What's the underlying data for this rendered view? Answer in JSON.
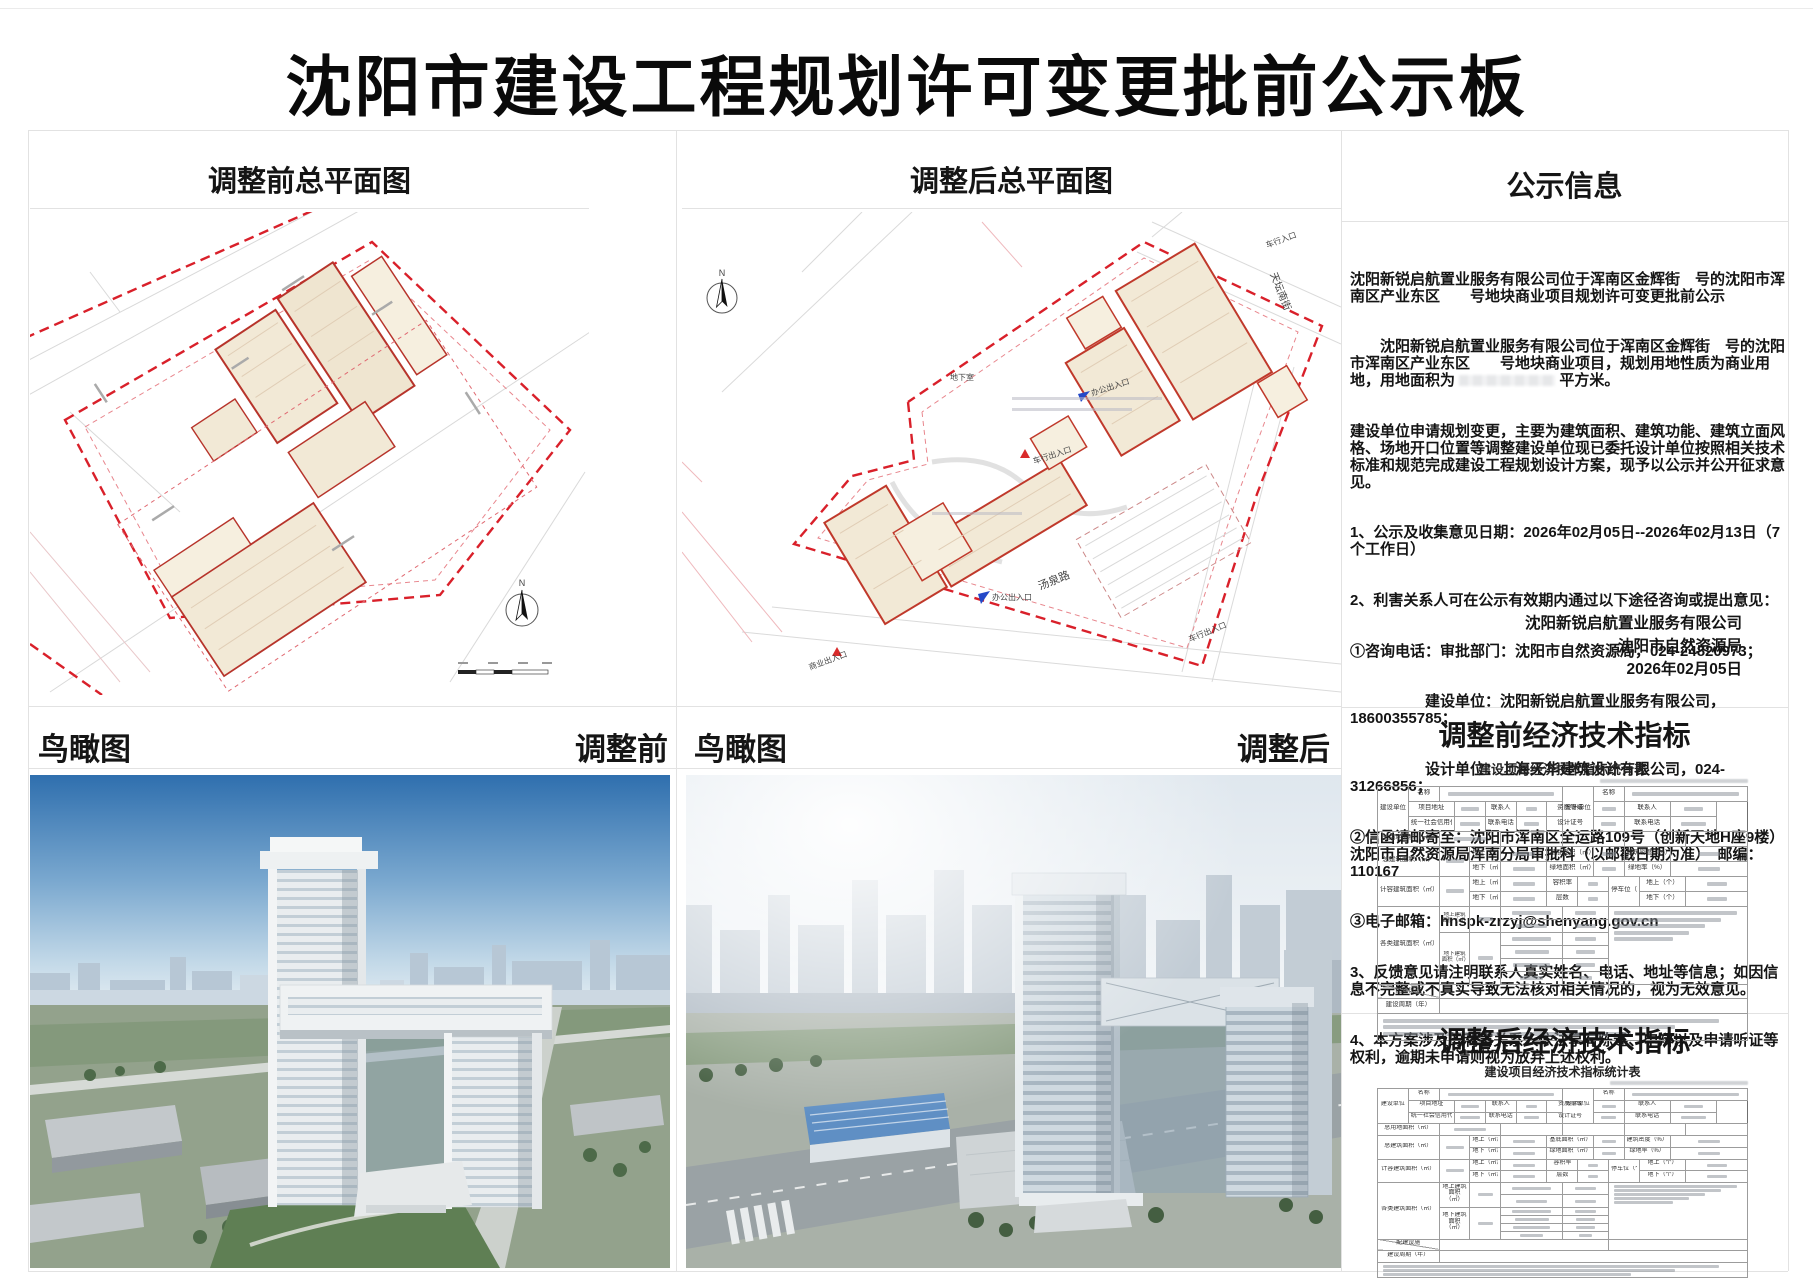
{
  "title": "沈阳市建设工程规划许可变更批前公示板",
  "sections": {
    "plan_before_header": "调整前总平面图",
    "plan_after_header": "调整后总平面图",
    "notice_header": "公示信息",
    "aerial_label": "鸟瞰图",
    "aerial_before_tag": "调整前",
    "aerial_after_tag": "调整后",
    "indicators_before_header": "调整前经济技术指标",
    "indicators_after_header": "调整后经济技术指标"
  },
  "notice": {
    "p1": "沈阳新锐启航置业服务有限公司位于浑南区金辉街　号的沈阳市浑南区产业东区　　号地块商业项目规划许可变更批前公示",
    "p2a": "　　沈阳新锐启航置业服务有限公司位于浑南区金辉街　号的沈阳市浑南区产业东区　　号地块商业项目，规划用地性质为商业用地，用地面积为 ",
    "p2b": " 平方米。",
    "p3": "建设单位申请规划变更，主要为建筑面积、建筑功能、建筑立面风格、场地开口位置等调整建设单位现已委托设计单位按照相关技术标准和规范完成建设工程规划设计方案，现予以公示并公开征求意见。",
    "p4": "1、公示及收集意见日期：2026年02月05日--2026年02月13日（7个工作日）",
    "p5": "2、利害关系人可在公示有效期内通过以下途径咨询或提出意见：",
    "p6": "①咨询电话：审批部门：沈阳市自然资源局，024-24820973；",
    "p7": "　　　　　建设单位：沈阳新锐启航置业服务有限公司，18600355785；",
    "p8": "　　　　　设计单位：上海天华建筑设计有限公司，024-31266856；",
    "p9": "②信函请邮寄至：沈阳市浑南区全运路109号（创新天地H座9楼）沈阳市自然资源局浑南分局审批科（以邮戳日期为准）　邮编：110167",
    "p10": "③电子邮箱：hnspk-zrzyj@shenyang.gov.cn",
    "p11": "3、反馈意见请注明联系人真实姓名、电话、地址等信息；如因信息不完整或不真实导致无法核对相关情况的，视为无效意见。",
    "p12": "4、本方案涉及的利害关系人依法享有陈述、申辩以及申请听证等权利，逾期未申请则视为放弃上述权利。",
    "sig1": "沈阳新锐启航置业服务有限公司",
    "sig2": "沈阳市自然资源局",
    "sig3": "2026年02月05日"
  },
  "plan_labels": {
    "street_tangquan": "汤泉路",
    "street_tiantan": "天坛南街",
    "entry_vehicle": "车行入口",
    "entry_vehicle_io": "车行出入口",
    "entry_office": "办公出入口",
    "entry_business": "商业出入口",
    "basement": "地下室",
    "north": "N"
  },
  "table": {
    "title": "建设项目经济技术指标统计表",
    "colors": {
      "boundary_red": "#d9202a",
      "building_fill": "#f2e9d6",
      "building_stroke": "#b7342b"
    },
    "spec": [
      [
        {
          "t": "建设单位",
          "cs": 2,
          "rs": 3
        },
        {
          "t": "名称",
          "cs": 2
        },
        {
          "b": 90,
          "cs": 8
        },
        {
          "t": "设计单位",
          "cs": 2,
          "rs": 3
        },
        {
          "t": "名称",
          "cs": 2
        },
        {
          "b": 90,
          "cs": 8
        }
      ],
      [
        {
          "t": "项目地址",
          "cs": 3
        },
        {
          "b": 70,
          "cs": 2
        },
        {
          "t": "联系人",
          "cs": 2
        },
        {
          "b": 45,
          "cs": 2
        },
        {
          "t": "资质等级",
          "cs": 3
        },
        {
          "b": 55,
          "cs": 2
        },
        {
          "t": "联系人",
          "cs": 3
        },
        {
          "b": 45,
          "cs": 3
        }
      ],
      [
        {
          "t": "统一社会信用代码",
          "cs": 3
        },
        {
          "b": 80,
          "cs": 2
        },
        {
          "t": "联系电话",
          "cs": 2
        },
        {
          "b": 60,
          "cs": 2
        },
        {
          "t": "设计证号",
          "cs": 3
        },
        {
          "b": 60,
          "cs": 2
        },
        {
          "t": "联系电话",
          "cs": 3
        },
        {
          "b": 60,
          "cs": 3
        }
      ],
      [
        {
          "t": "总用地面积（㎡）",
          "cs": 4
        },
        {
          "b": 55,
          "cs": 4
        },
        {
          "cs": 4
        },
        {
          "cs": 4
        },
        {
          "cs": 4
        },
        {
          "cs": 4
        }
      ],
      [
        {
          "t": "总建筑面积（㎡）",
          "cs": 4,
          "rs": 2
        },
        {
          "b": 70,
          "cs": 2,
          "rs": 2
        },
        {
          "t": "地上（㎡）",
          "cs": 2
        },
        {
          "b": 55,
          "cs": 3
        },
        {
          "t": "基底面积（㎡）",
          "cs": 3
        },
        {
          "b": 55,
          "cs": 2
        },
        {
          "t": "建筑密度（%）",
          "cs": 3
        },
        {
          "b": 30,
          "cs": 5
        }
      ],
      [
        {
          "t": "地下（㎡）",
          "cs": 2
        },
        {
          "b": 55,
          "cs": 3
        },
        {
          "t": "绿地面积（㎡）",
          "cs": 3
        },
        {
          "b": 55,
          "cs": 2
        },
        {
          "t": "绿地率（%）",
          "cs": 3
        },
        {
          "b": 30,
          "cs": 5
        }
      ],
      [
        {
          "t": "计容建筑面积（㎡）",
          "cs": 4,
          "rs": 2
        },
        {
          "b": 70,
          "cs": 2,
          "rs": 2
        },
        {
          "t": "地上（㎡）",
          "cs": 2
        },
        {
          "b": 55,
          "cs": 3
        },
        {
          "t": "容积率",
          "cs": 2
        },
        {
          "b": 40,
          "cs": 2
        },
        {
          "t": "停车位（个）",
          "cs": 2,
          "rs": 2
        },
        {
          "t": "地上（个）",
          "cs": 3
        },
        {
          "b": 35,
          "cs": 4
        }
      ],
      [
        {
          "t": "地下（㎡）",
          "cs": 2
        },
        {
          "b": 55,
          "cs": 3
        },
        {
          "t": "层数",
          "cs": 2
        },
        {
          "b": 40,
          "cs": 2
        },
        {
          "t": "地下（个）",
          "cs": 3
        },
        {
          "b": 35,
          "cs": 4
        }
      ],
      [
        {
          "t": "各类建筑面积（㎡）",
          "cs": 4,
          "rs": 6
        },
        {
          "t": "地上建筑面积（㎡）",
          "cs": 2,
          "rs": 2,
          "cls": "sm"
        },
        {
          "b": 60,
          "cs": 2,
          "rs": 2
        },
        {
          "b": 70,
          "cs": 4
        },
        {
          "b": 50,
          "cs": 3
        },
        {
          "lines": 5,
          "cs": 9,
          "rs": 6,
          "cls": "notecell"
        }
      ],
      [
        {
          "b": 55,
          "cs": 4
        },
        {
          "b": 50,
          "cs": 3
        }
      ],
      [
        {
          "t": "地下建筑面积（㎡）",
          "cs": 2,
          "rs": 4,
          "cls": "sm"
        },
        {
          "b": 60,
          "cs": 2,
          "rs": 4
        },
        {
          "b": 70,
          "cs": 4
        },
        {
          "b": 50,
          "cs": 3
        }
      ],
      [
        {
          "b": 60,
          "cs": 4
        },
        {
          "b": 45,
          "cs": 3
        }
      ],
      [
        {
          "b": 65,
          "cs": 4
        },
        {
          "b": 45,
          "cs": 3
        }
      ],
      [
        {
          "b": 40,
          "cs": 4
        },
        {
          "b": 30,
          "cs": 3
        }
      ],
      [
        {
          "t": "配建设施",
          "cs": 4,
          "cls": "diag"
        },
        {
          "cs": 11
        },
        {
          "cs": 9
        }
      ],
      [
        {
          "t": "建设周期（年）",
          "cs": 4
        },
        {
          "cs": 20
        }
      ],
      [
        {
          "lines": 3,
          "cs": 24,
          "cls": "notesrow"
        }
      ]
    ]
  }
}
